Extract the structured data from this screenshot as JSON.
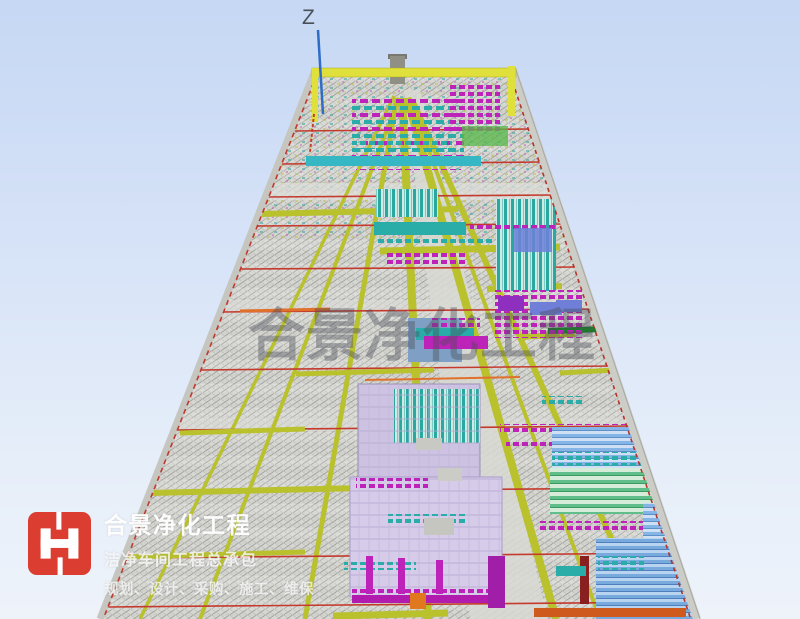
{
  "viewport": {
    "axis": {
      "z_label": "Z"
    },
    "watermark": {
      "text": "合景净化工程"
    }
  },
  "branding": {
    "logo_icon": "hejing-h-monogram-icon",
    "company_name": "合景净化工程",
    "tagline": "洁净车间工程总承包",
    "services": "规划、设计、采购、施工、维保"
  },
  "colors": {
    "sky_top": "#c6d8f4",
    "sky_bottom": "#eef3fa",
    "logo_red": "#dc3d31",
    "axis_blue": "#2e6cc8",
    "pipe_yellow_green": "#b9c12d",
    "top_rail_yellow": "#e0e03c",
    "duct_magenta": "#bd23b8",
    "duct_teal": "#2aada8",
    "duct_cyan": "#35b8c4",
    "duct_light_blue": "#85b4e6",
    "duct_blue_violet": "#6f7fd8",
    "sprinkler_red": "#c43b2e",
    "orange_line": "#e0712c",
    "panel_lavender": "#cdc2e2",
    "structure_gray": "#d6d6d3",
    "dark_green": "#1f7a2e"
  }
}
